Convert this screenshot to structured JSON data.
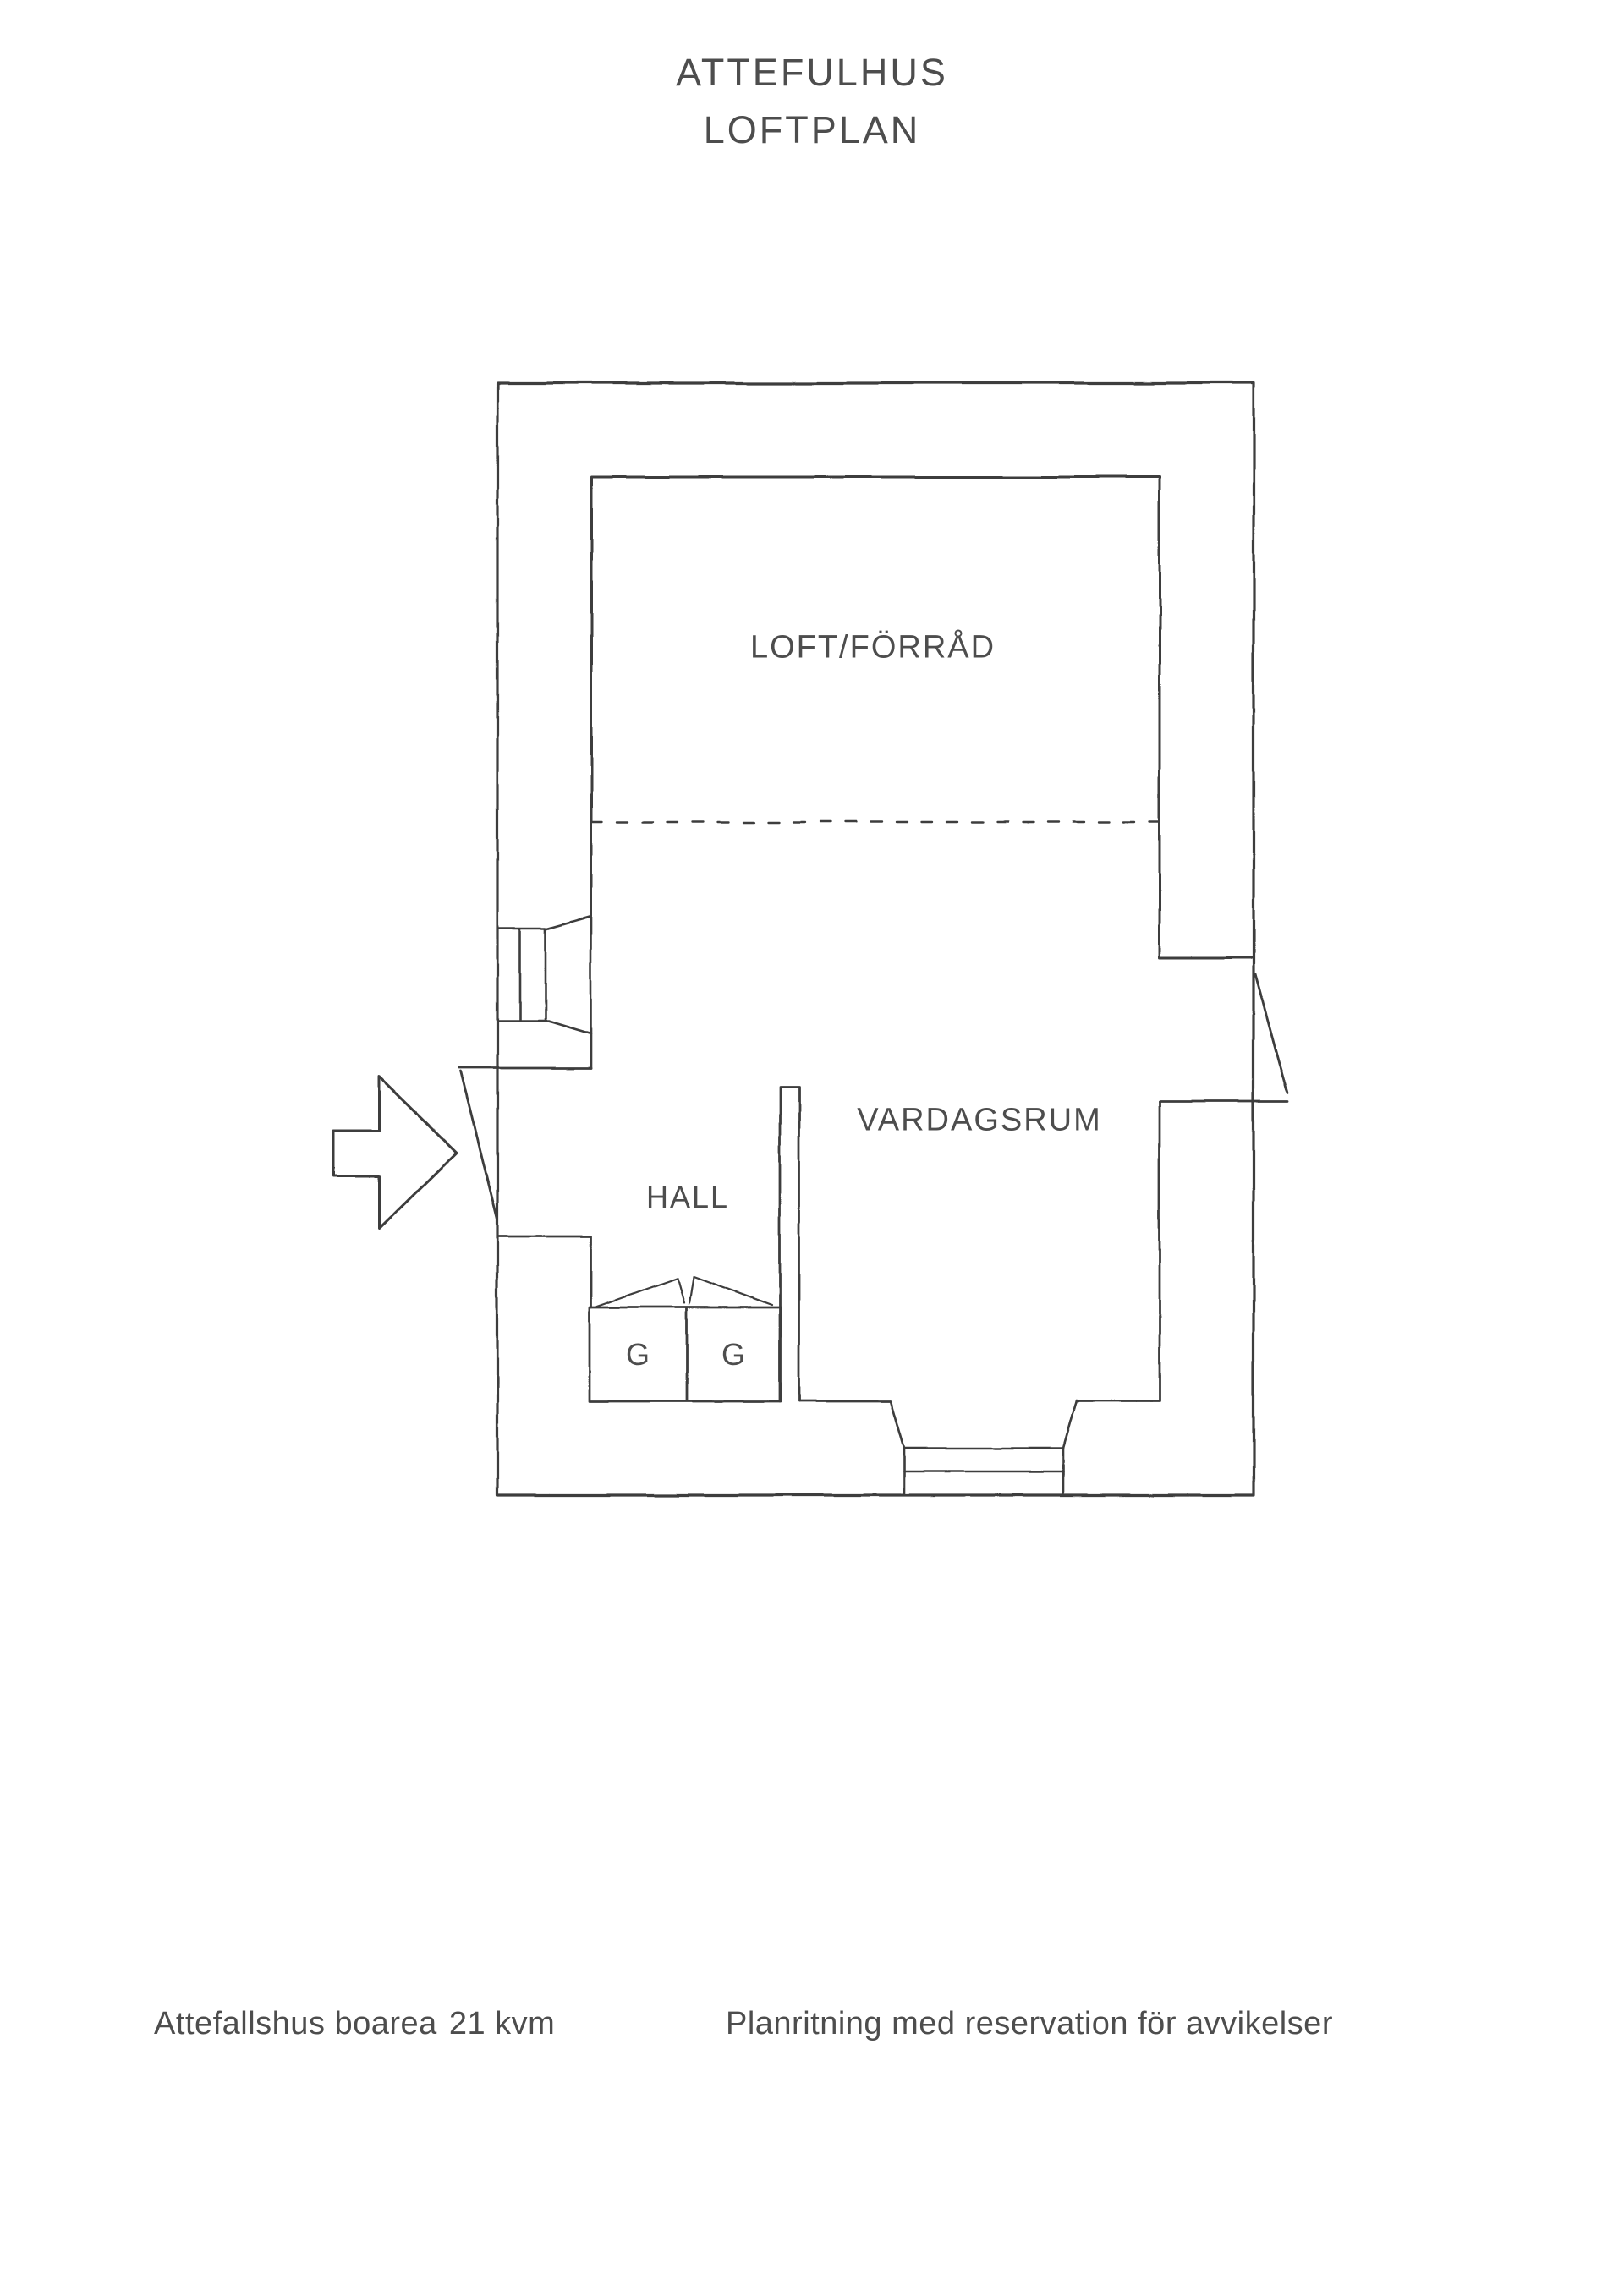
{
  "page": {
    "title_line1": "ATTEFULHUS",
    "title_line2": "LOFTPLAN"
  },
  "rooms": {
    "loft_label": "LOFT/FÖRRÅD",
    "living_label": "VARDAGSRUM",
    "hall_label": "HALL",
    "wardrobe_left_label": "G",
    "wardrobe_right_label": "G"
  },
  "footer": {
    "area_label": "Attefallshus boarea",
    "area_value": "21 kvm",
    "disclaimer": "Planritning med reservation för avvikelser"
  },
  "icons": {
    "entry_arrow": "block-arrow-right"
  },
  "colors": {
    "line": "#3e3e3e",
    "text": "#4d4d4d",
    "background": "#ffffff"
  }
}
